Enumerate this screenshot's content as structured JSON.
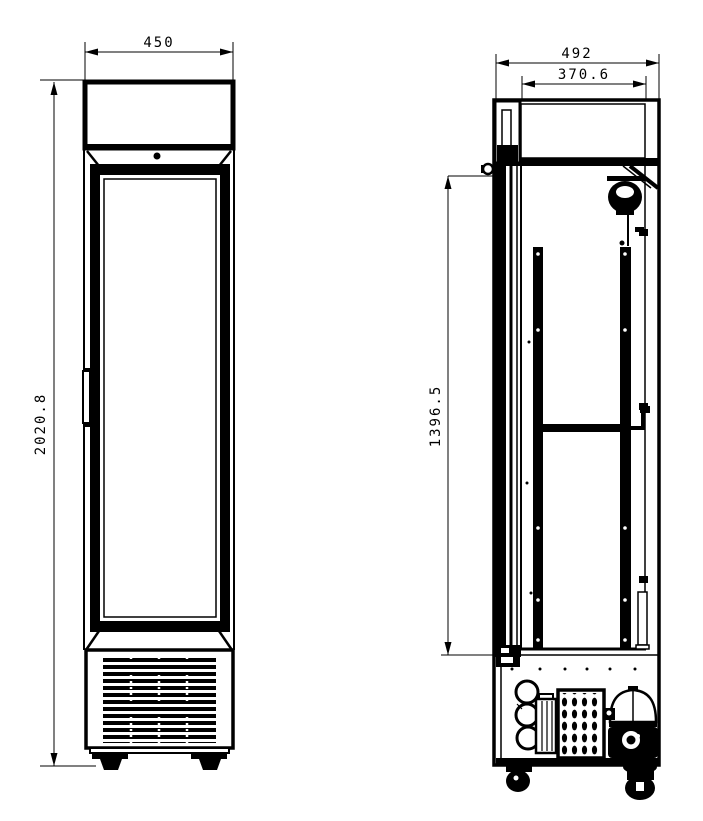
{
  "meta": {
    "drawing_type": "technical dimension drawing",
    "subject": "single glass-door upright display cooler",
    "views": [
      "front elevation",
      "side elevation"
    ]
  },
  "colors": {
    "line": "#000000",
    "background": "#ffffff"
  },
  "front_view": {
    "label": "front elevation",
    "width_mm": "450",
    "height_mm": "2020.8"
  },
  "side_view": {
    "label": "side elevation",
    "depth_mm": "492",
    "door_depth_mm": "370.6",
    "interior_height_mm": "1396.5"
  },
  "icons": {
    "brand_mark": "illegible-small-brand-text",
    "lock_dot": "door-lock-pin"
  }
}
